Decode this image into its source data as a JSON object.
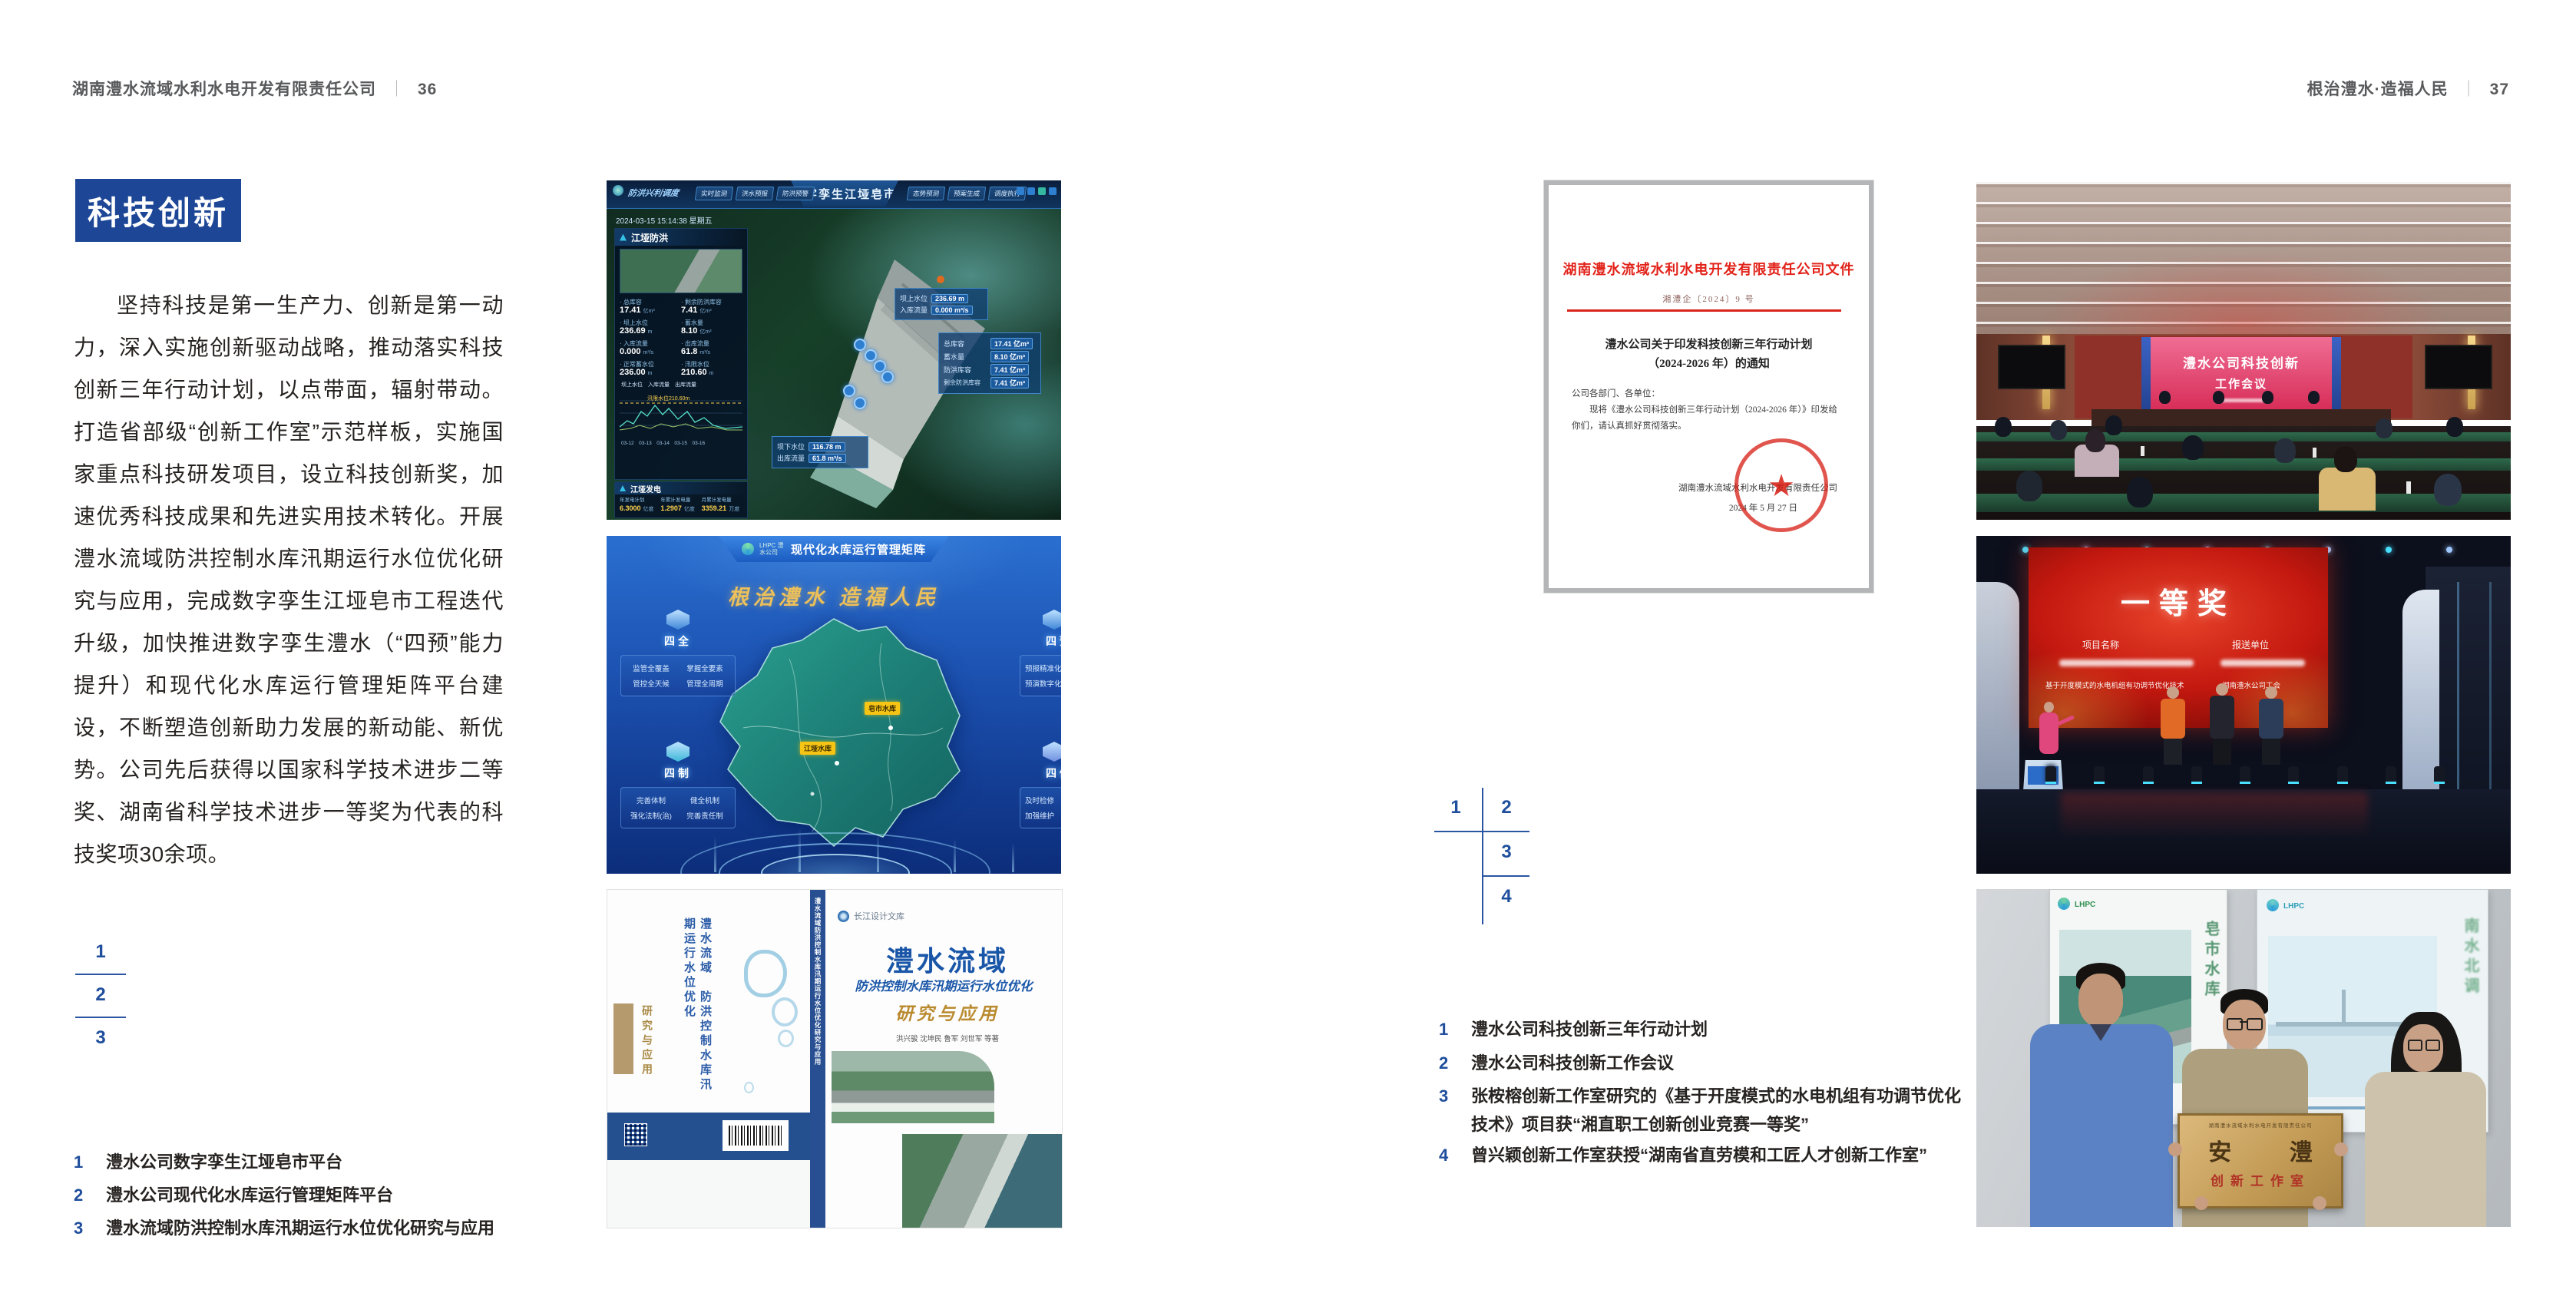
{
  "header": {
    "left_title": "湖南澧水流域水利水电开发有限责任公司",
    "left_page": "36",
    "right_title": "根治澧水·造福人民",
    "right_page": "37",
    "separator": "｜"
  },
  "left_page": {
    "badge": "科技创新",
    "paragraph": "坚持科技是第一生产力、创新是第一动力，深入实施创新驱动战略，推动落实科技创新三年行动计划，以点带面，辐射带动。打造省部级“创新工作室”示范样板，实施国家重点科技研发项目，设立科技创新奖，加速优秀科技成果和先进实用技术转化。开展澧水流域防洪控制水库汛期运行水位优化研究与应用，完成数字孪生江垭皂市工程迭代升级，加快推进数字孪生澧水（“四预”能力提升）和现代化水库运行管理矩阵平台建设，不断塑造创新助力发展的新动能、新优势。公司先后获得以国家科学技术进步二等奖、湖南省科学技术进步一等奖为代表的科技奖项30余项。",
    "figure_index": {
      "n1": "1",
      "n2": "2",
      "n3": "3"
    },
    "captions": [
      {
        "num": "1",
        "text": "澧水公司数字孪生江垭皂市平台"
      },
      {
        "num": "2",
        "text": "澧水公司现代化水库运行管理矩阵平台"
      },
      {
        "num": "3",
        "text": "澧水流域防洪控制水库汛期运行水位优化研究与应用"
      }
    ]
  },
  "right_page": {
    "figure_index": {
      "n1": "1",
      "n2": "2",
      "n3": "3",
      "n4": "4"
    },
    "captions": [
      {
        "num": "1",
        "text": "澧水公司科技创新三年行动计划"
      },
      {
        "num": "2",
        "text": "澧水公司科技创新工作会议"
      },
      {
        "num": "3",
        "text": "张桉榕创新工作室研究的《基于开度模式的水电机组有功调节优化技术》项目获“湘直职工创新创业竞赛一等奖”"
      },
      {
        "num": "4",
        "text": "曾兴颖创新工作室获授“湖南省直劳模和工匠人才创新工作室”"
      }
    ]
  },
  "fig_dashboard": {
    "module_title": "防洪兴利调度",
    "system_title": "数字孪生江垭皂市",
    "timestamp": "2024-03-15 15:14:38 星期五",
    "nav_left": [
      "实时监测",
      "洪水预报",
      "防洪预警"
    ],
    "nav_right": [
      "态势预测",
      "预案生成",
      "调度执行"
    ],
    "panel_flood_title": "江垭防洪",
    "panel_power_title": "江垭发电",
    "flood_stats": [
      {
        "label": "总库容",
        "value": "17.41",
        "unit": "亿m³"
      },
      {
        "label": "剩余防洪库容",
        "value": "7.41",
        "unit": "亿m³"
      },
      {
        "label": "坝上水位",
        "value": "236.69",
        "unit": "m"
      },
      {
        "label": "蓄水量",
        "value": "8.10",
        "unit": "亿m³"
      },
      {
        "label": "入库流量",
        "value": "0.000",
        "unit": "m³/s"
      },
      {
        "label": "出库流量",
        "value": "61.8",
        "unit": "m³/s"
      },
      {
        "label": "正常蓄水位",
        "value": "236.00",
        "unit": "m"
      },
      {
        "label": "汛限水位",
        "value": "210.60",
        "unit": "m"
      }
    ],
    "legend": "坝上水位　入库流量　出库流量",
    "chart_annotation": "汛限水位210.60m",
    "axis_dates": "03-12　03-13　03-14　03-15　03-16",
    "power_stats": [
      {
        "label": "年发电计划",
        "value": "6.3000",
        "unit": "亿度"
      },
      {
        "label": "年累计发电量",
        "value": "1.2907",
        "unit": "亿度"
      },
      {
        "label": "月累计发电量",
        "value": "3359.21",
        "unit": "万度"
      },
      {
        "label": "当前出力",
        "value": "0.00",
        "unit": "MW"
      },
      {
        "label": "发电流量",
        "value": "0.00",
        "unit": "m³/s"
      },
      {
        "label": "弃水流量",
        "value": "0.00",
        "unit": "m³/s"
      }
    ],
    "callout_up": {
      "l1": "坝上水位",
      "v1": "236.69 m",
      "l2": "入库流量",
      "v2": "0.000 m³/s"
    },
    "info_rows": [
      {
        "label": "总库容",
        "value": "17.41 亿m³"
      },
      {
        "label": "蓄水量",
        "value": "8.10 亿m³"
      },
      {
        "label": "防洪库容",
        "value": "7.41 亿m³"
      },
      {
        "label": "剩余防洪库容",
        "value": "7.41 亿m³"
      }
    ],
    "callout_down": {
      "l1": "坝下水位",
      "v1": "116.78 m",
      "l2": "出库流量",
      "v2": "61.8 m³/s"
    }
  },
  "fig_matrix": {
    "logo_text": "LHPC 澧水公司",
    "title": "现代化水库运行管理矩阵",
    "slogan": "根治澧水  造福人民",
    "cards": [
      {
        "title": "四全",
        "lines": [
          "监管全覆盖",
          "掌握全要素",
          "管控全天候",
          "管理全周期"
        ]
      },
      {
        "title": "四制",
        "lines": [
          "完善体制",
          "健全机制",
          "强化法制(治)",
          "完善责任制"
        ]
      },
      {
        "title": "四预",
        "lines": [
          "预报精准化",
          "预演数字化"
        ]
      },
      {
        "title": "四修",
        "lines": [
          "及时检修",
          "加强维护"
        ]
      }
    ],
    "labels": [
      "江垭水库",
      "皂市水库"
    ]
  },
  "fig_book": {
    "series": "长江设计文库",
    "title_main": "澧水流域",
    "title_sub": "防洪控制水库汛期运行水位优化",
    "title_tail": "研究与应用",
    "authors": "洪兴骏  沈坤民  鲁军  刘世军  等著",
    "spine_text": "澧水流域防洪控制水库汛期运行水位优化研究与应用",
    "back_l1": "澧水流域",
    "back_l2": "防洪控制水库汛期运行水位优化",
    "back_tail": "研究与应用"
  },
  "fig_document": {
    "header": "湖南澧水流域水利水电开发有限责任公司文件",
    "doc_no": "湘澧企〔2024〕9 号",
    "title1": "澧水公司关于印发科技创新三年行动计划",
    "title2": "（2024-2026 年）的通知",
    "salutation": "公司各部门、各单位：",
    "body": "现将《澧水公司科技创新三年行动计划（2024-2026 年）》印发给你们，请认真抓好贯彻落实。",
    "signer": "湖南澧水流域水利水电开发有限责任公司",
    "date": "2024 年 5 月 27 日"
  },
  "fig_meeting": {
    "line1": "澧水公司科技创新",
    "line2": "工作会议"
  },
  "fig_award": {
    "title": "一等奖",
    "col1": "项目名称",
    "col2": "报送单位",
    "project": "基于开度模式的水电机组有功调节优化技术",
    "unit": "湖南澧水公司工会"
  },
  "fig_plaque": {
    "org": "湖南澧水流域水利水电开发有限责任公司",
    "name": "安 澧",
    "title": "创新工作室",
    "poster_left": "皂市水库",
    "poster_right": "南水北调",
    "logo": "LHPC"
  }
}
